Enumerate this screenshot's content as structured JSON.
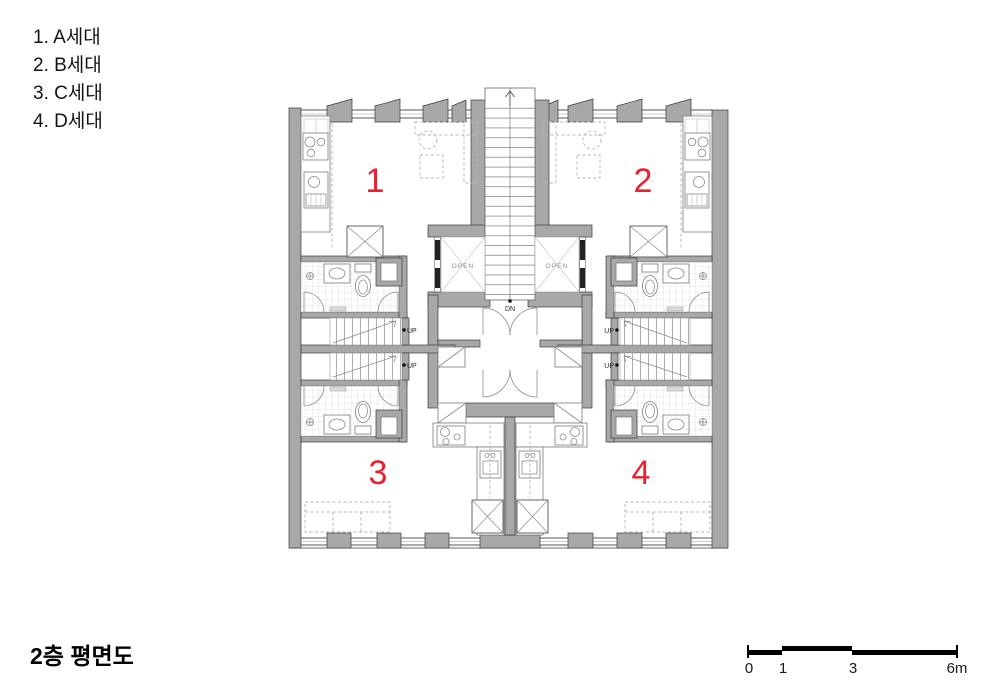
{
  "legend": {
    "items": [
      "1. A세대",
      "2. B세대",
      "3. C세대",
      "4. D세대"
    ]
  },
  "title": "2층 평면도",
  "plan": {
    "unit_numbers": [
      "1",
      "2",
      "3",
      "4"
    ],
    "labels": {
      "open": "OPEN",
      "up": "UP",
      "down": "DN"
    }
  },
  "scale_bar": {
    "tick_labels": [
      "0",
      "1",
      "3",
      "6m"
    ],
    "unit_meters": [
      0,
      1,
      3,
      6
    ]
  },
  "colors": {
    "wall_gray": "#a8a8a8",
    "unit_number_red": "#e8212e",
    "drawing_black": "#1a1a1a"
  }
}
